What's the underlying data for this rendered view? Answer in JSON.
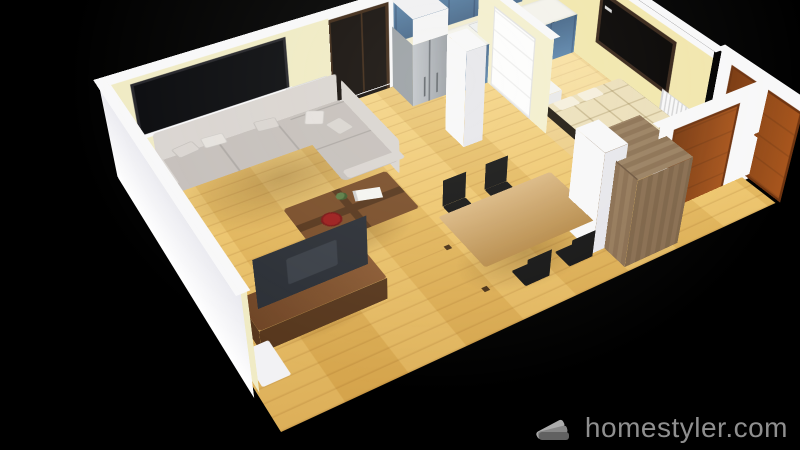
{
  "watermark": {
    "icon": "homestyler-fan-icon",
    "text": "homestyler.com"
  },
  "scene": {
    "type": "3d-floorplan-render",
    "background": "black",
    "rooms": [
      {
        "name": "living-room",
        "items": [
          "window",
          "radiator",
          "sectional-sofa",
          "throw-pillows",
          "coffee-table",
          "decor-plate",
          "magazine",
          "table-plant",
          "tv-stand",
          "tv-screen",
          "side-shelf"
        ]
      },
      {
        "name": "kitchen",
        "items": [
          "refrigerator",
          "over-fridge-cabinet",
          "upper-cabinets",
          "base-cabinets",
          "countertop",
          "gas-cooktop",
          "oven",
          "fruit-bowl",
          "balcony-door"
        ]
      },
      {
        "name": "dining-area",
        "items": [
          "dining-table",
          "dining-chairs-x4",
          "wardrobe",
          "wall-column"
        ]
      },
      {
        "name": "bedroom",
        "items": [
          "bed",
          "pillows",
          "dresser",
          "fruit-bowl",
          "wall-tv",
          "white-interior-door",
          "radiator"
        ]
      },
      {
        "name": "hallway",
        "items": [
          "wood-door",
          "wood-door"
        ]
      }
    ]
  },
  "palette": {
    "bg": "#000000",
    "wallWhite": "#f8f8f9",
    "wallShade": "#e7e7ec",
    "wallCream": "#f0ebc5",
    "wallYellow": "#f2e7ae",
    "floorLight": "#f5d485",
    "floorMid": "#ecc267",
    "floorDark": "#d9a84e",
    "sofa": "#c6c0bc",
    "sofaLight": "#dad5d1",
    "sofaDark": "#a49d99",
    "walnut": "#7a4e2a",
    "walnutDark": "#57371d",
    "oak": "#cd9d55",
    "chairBlack": "#161616",
    "cabinetBlue": "#5d86ac",
    "cabinetBlueDark": "#47688a",
    "counterWhite": "#f4f3ec",
    "steel": "#b9bdc2",
    "steelDark": "#878c92",
    "quilt": "#ece0bc",
    "bedFrame": "#221b13",
    "doorOrange": "#a8561e",
    "doorOrangeDark": "#7c3c12",
    "tvDark": "#2b2f36",
    "doorWhite": "#fdfdfd",
    "watermarkGray": "#a3a3a3"
  }
}
